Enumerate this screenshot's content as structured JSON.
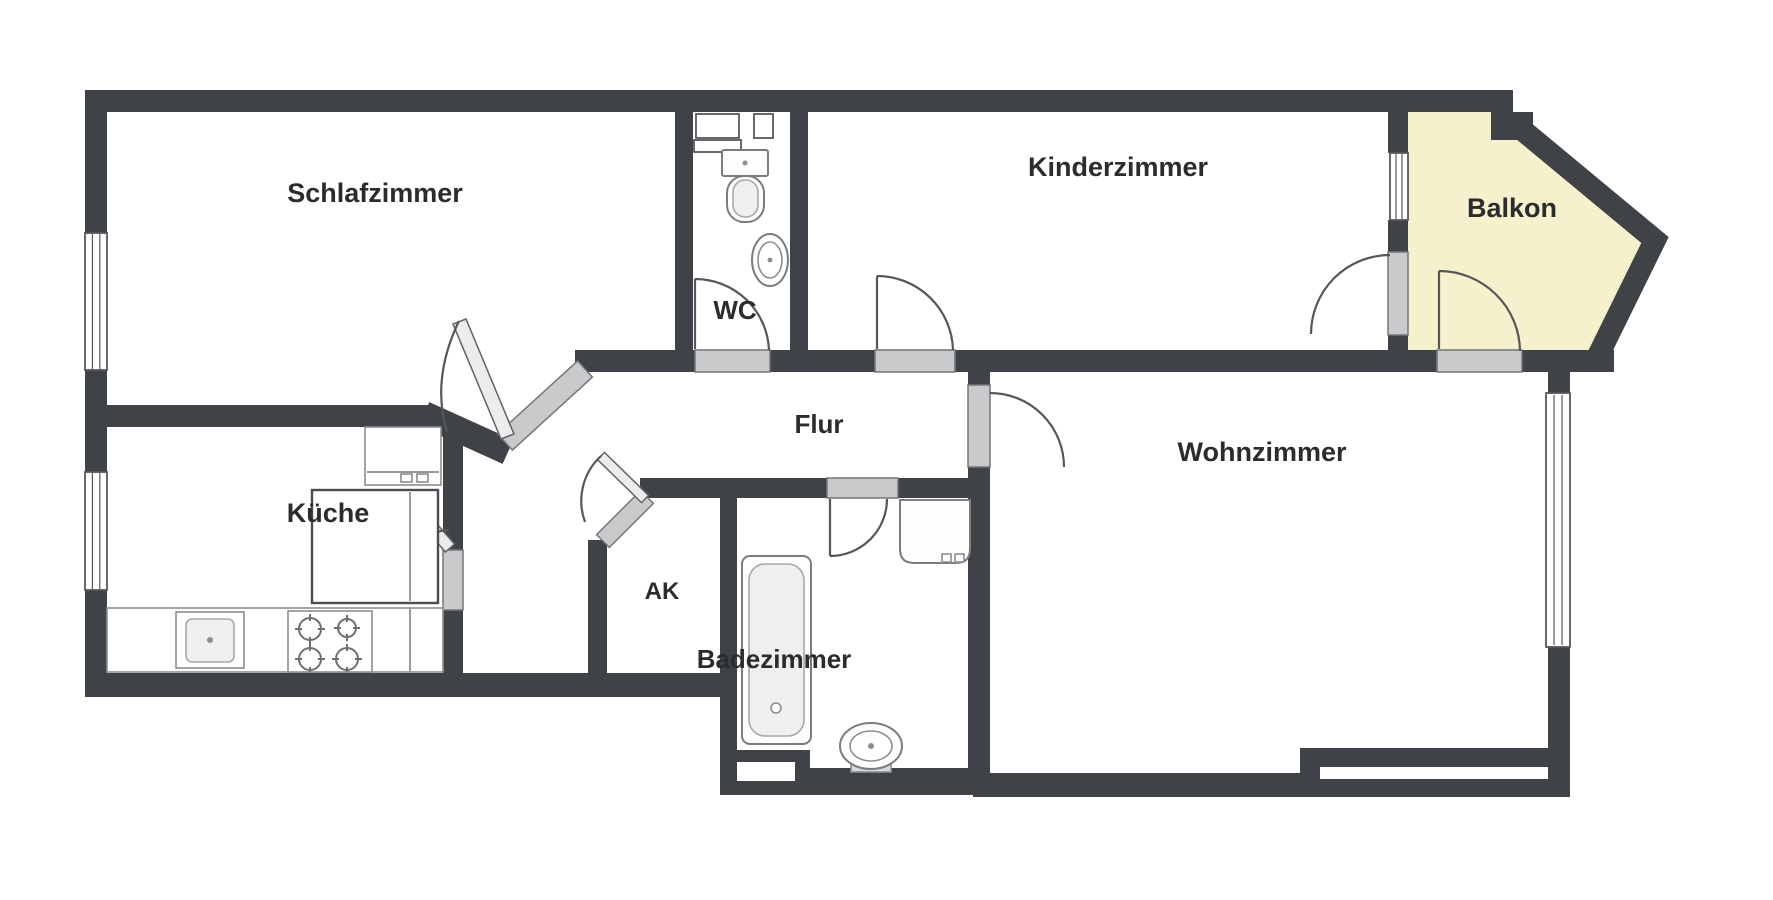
{
  "document": {
    "kind": "apartment-floor-plan",
    "style": "2D black-and-white architectural plan with highlighted balcony"
  },
  "rooms": {
    "schlafzimmer": "Schlafzimmer",
    "wc": "WC",
    "kinderzimmer": "Kinderzimmer",
    "balkon": "Balkon",
    "flur": "Flur",
    "kueche": "Küche",
    "ak": "AK",
    "badezimmer": "Badezimmer",
    "wohnzimmer": "Wohnzimmer"
  },
  "colors": {
    "wall": "#3f4347",
    "balcony_fill": "#f5f1cd",
    "door_threshold": "#c8cacb",
    "background": "#ffffff",
    "label_text": "#2a2c2d"
  },
  "fixtures": [
    "wc-toilet-icon",
    "wc-washbasin-icon",
    "bathtub-icon",
    "bath-washbasin-icon",
    "bath-toilet-icon",
    "kitchen-sink-icon",
    "stove-burners-icon",
    "kitchen-counter",
    "kitchen-island",
    "window-symbols",
    "door-swing-symbols"
  ]
}
